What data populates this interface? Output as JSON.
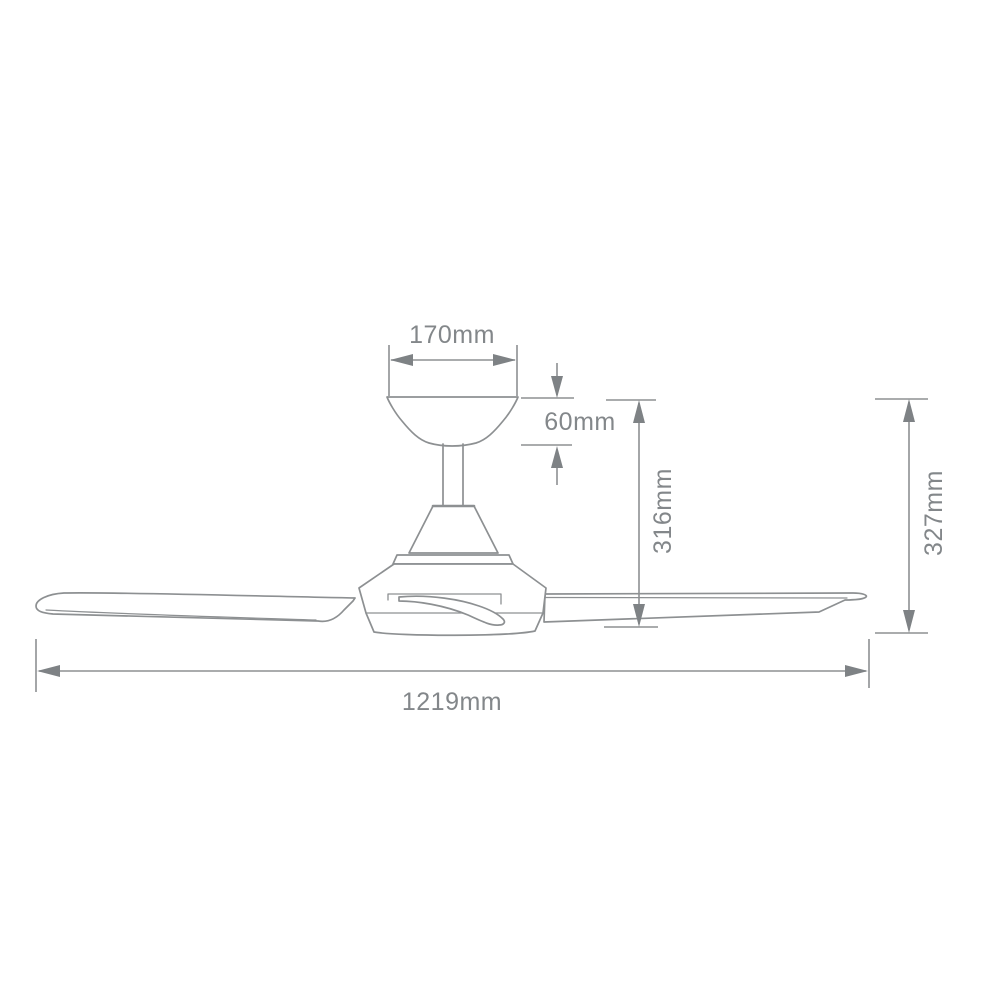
{
  "drawing": {
    "subject": "ceiling-fan-side-elevation-dimension-diagram",
    "background": "#ffffff",
    "line_color": "#8d9092",
    "arrow_color": "#7e8285",
    "text_color": "#83878a"
  },
  "labels": {
    "canopy_width": "170mm",
    "canopy_height": "60mm",
    "height_to_blade": "316mm",
    "overall_height": "327mm",
    "blade_sweep": "1219mm"
  },
  "dimensions_mm": {
    "canopy_width": 170,
    "canopy_height": 60,
    "height_to_blade": 316,
    "overall_height": 327,
    "blade_sweep": 1219
  }
}
